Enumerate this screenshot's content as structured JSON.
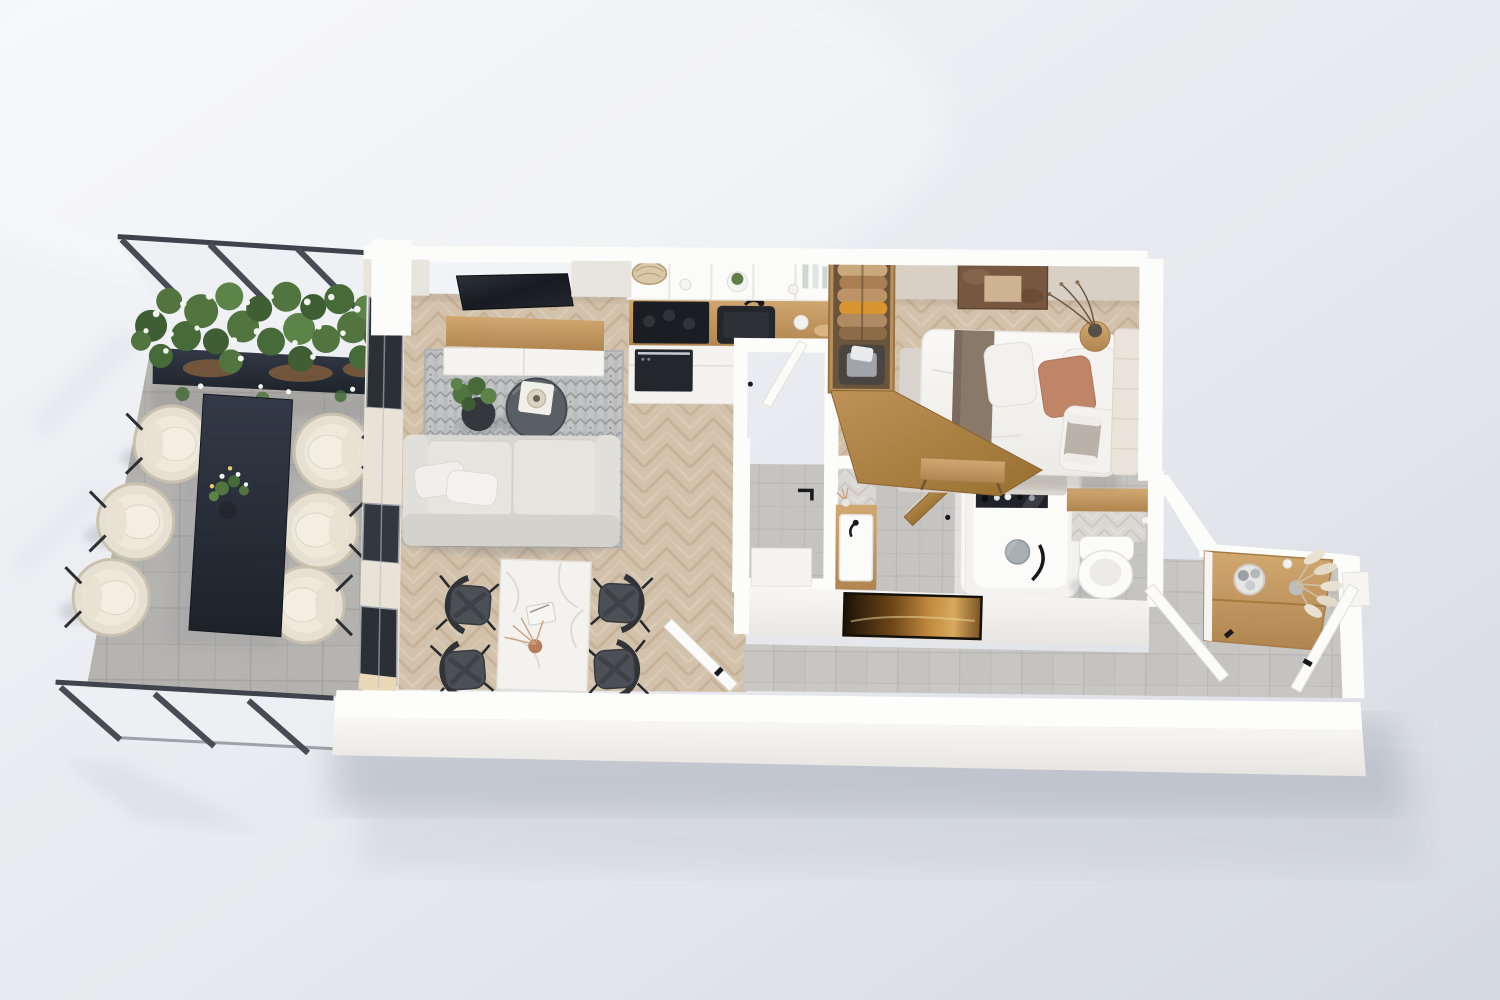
{
  "title": "3D apartment floor plan render",
  "view": "top-down 3D render of a one-bedroom apartment with terrace, no visible text or UI chrome",
  "background": {
    "light": "#f5f6f8",
    "base": "#e9ebf0",
    "dark": "#d2d6de"
  },
  "palette": {
    "bgLight": "#f4f5f8",
    "bgMid": "#e7e9ee",
    "bgDark": "#d5d9e1",
    "shadow": "#aab0bc",
    "wallTop": "#fcfcfb",
    "wallFace": "#f1efec",
    "wallInner": "#d8d0c5",
    "wallInnerLight": "#e8e4de",
    "woodBase": "#d3c2ab",
    "woodDark": "#bda689",
    "woodLight": "#e2d4bf",
    "oak": "#c89e66",
    "oakDark": "#a67c47",
    "terraceTile": "#b4b2af",
    "terraceGrout": "#a19f9c",
    "hallTile": "#c8c6c3",
    "hallGrout": "#b5b3b0",
    "concrete": "#c6c4c1",
    "glassPost": "#484c55",
    "glassTint": "#e8ecf0",
    "navyTable": "#272d37",
    "chairCream": "#e6e0d3",
    "chairRim": "#c9c0ae",
    "sofaBody": "#d9d7d2",
    "sofaSeat": "#e6e4df",
    "rugBase": "#c2c4c5",
    "rugMotif": "#8e9194",
    "tvBlack": "#1b1f25",
    "marble": "#f4f2ef",
    "marbleVein": "#d8d5d1",
    "chairDark": "#4b4f56",
    "chairDarkFrame": "#303439",
    "bedWhite": "#f7f6f3",
    "bedRunner": "#897969",
    "pillowTerracotta": "#c08467",
    "headboard": "#e9e3d9",
    "bedroomRug": "#d8d3cd",
    "artBrown": "#77573f",
    "artBrownInner": "#cdb392",
    "amberDark": "#1c1207",
    "amberMid": "#6e4518",
    "amberLight": "#d8a95e",
    "tileWall": "#dbd8d4",
    "tileWallDark": "#c7c4c0",
    "fixtureWhite": "#fbfbfa",
    "black": "#17191c",
    "towelGray": "#9fa5ab",
    "clothesTan": "#c9a87c",
    "clothesBrown": "#a97f52",
    "clothesOrange": "#d9952f",
    "pampas": "#e9e1d1",
    "plantGreen": "#527540",
    "plantGreenDark": "#3f5e33",
    "flowerWhite": "#f3f5f0",
    "soil": "#7a5a3c"
  },
  "rooms": [
    {
      "id": "terrace",
      "label": "Terrace",
      "features": [
        "glass railing with metal posts",
        "long flower planter with white blossoms",
        "dark outdoor dining table",
        "six cream rope outdoor chairs",
        "flower centerpiece",
        "gray tile floor"
      ]
    },
    {
      "id": "living-room",
      "label": "Living room",
      "features": [
        "wall-mounted TV",
        "oak media console",
        "patterned gray rug",
        "round dark coffee table with tray and vase",
        "potted plant",
        "light gray three-seat sofa with two pillows",
        "white marble dining table with book and vase",
        "four dark wishbone dining chairs",
        "open white door to hallway",
        "oak herringbone floor",
        "floor-to-ceiling windows"
      ]
    },
    {
      "id": "kitchen",
      "label": "Kitchen",
      "features": [
        "white open shelving with bowl, cup, plant and bottles",
        "black cooktop",
        "built-in oven",
        "oak countertop",
        "black undermount sink with black faucet",
        "white cabinet fronts"
      ]
    },
    {
      "id": "shower-room",
      "label": "Shower room",
      "features": [
        "black towel rail",
        "white shower base",
        "gray tile floor",
        "white door"
      ]
    },
    {
      "id": "bathroom",
      "label": "Bathroom",
      "features": [
        "oak vanity with white basin and black faucet",
        "white bathtub with black filler",
        "black toiletry niche shelf",
        "round gray tub plate",
        "glass screen",
        "herringbone tiled accent wall",
        "open oak door"
      ]
    },
    {
      "id": "toilet",
      "label": "WC niche",
      "features": [
        "wall-hung white toilet",
        "oak shelf",
        "herringbone tiled wall",
        "toilet-paper holder"
      ]
    },
    {
      "id": "bedroom",
      "label": "Bedroom",
      "features": [
        "double bed with white duvet and taupe runner",
        "terracotta and white cushions",
        "upholstered cream headboard",
        "open oak wardrobe with hanging clothes and folded towels",
        "oak partition panel",
        "round side table with dark vase and dry branches",
        "brown abstract wall art",
        "light area rug",
        "oak bench"
      ]
    },
    {
      "id": "hallway",
      "label": "Hallway",
      "features": [
        "amber landscape artwork on wall",
        "large-format gray tile floor"
      ]
    },
    {
      "id": "entry",
      "label": "Entry",
      "features": [
        "oak sideboard",
        "basket with rolled towels",
        "vase with pampas grass",
        "two open white doors with black handles"
      ]
    }
  ]
}
